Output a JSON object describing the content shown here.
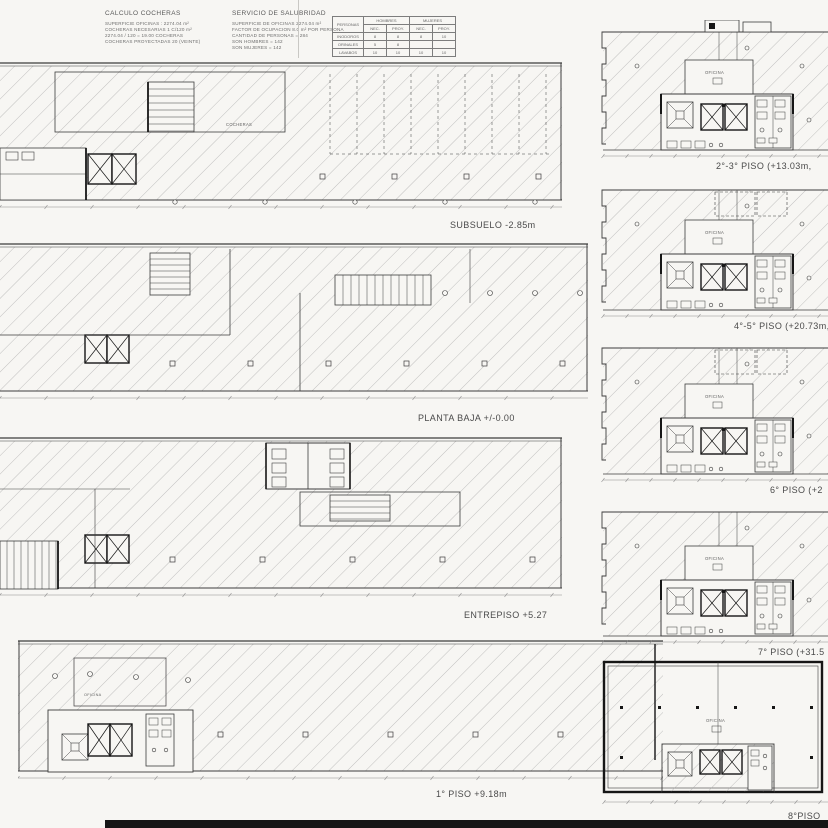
{
  "colors": {
    "paper": "#f7f6f3",
    "ink": "#3c3c3c",
    "heavy": "#161616",
    "hatch": "#a9a9a9",
    "dim": "#8a8a8a",
    "label": "#4a4a4a"
  },
  "header": {
    "calculo": {
      "title": "CALCULO COCHERAS",
      "lines": [
        "SUPERFICIE OFICINAS : 2274.04 m²",
        "COCHERAS NECESARIAS 1 C/120 m²",
        "2274.04 / 120 = 19.00 COCHERAS",
        "COCHERAS PROYECTADAS 20 (VEINTE)"
      ]
    },
    "servicio": {
      "title": "SERVICIO DE SALUBRIDAD",
      "lines": [
        "SUPERFICIE DE OFICINAS 2274.04 m²",
        "FACTOR DE OCUPACION 8.0 m² POR PERSONA",
        "CANTIDAD DE PERSONAS = 284",
        "SON HOMBRES = 142",
        "SON MUJERES = 142"
      ]
    },
    "table": {
      "corner": "PERSONAS",
      "col_groups": [
        "HOMBRES",
        "MUJERES"
      ],
      "sub_cols": [
        "NEC.",
        "PROY.",
        "NEC.",
        "PROY."
      ],
      "rows": [
        {
          "label": "INODOROS",
          "values": [
            "8",
            "8",
            "8",
            "10"
          ]
        },
        {
          "label": "ORINALES",
          "values": [
            "5",
            "8",
            "",
            ""
          ]
        },
        {
          "label": "LAVABOS",
          "values": [
            "10",
            "10",
            "10",
            "10"
          ]
        }
      ]
    }
  },
  "plans_left": [
    {
      "label": "SUBSUELO  -2.85m"
    },
    {
      "label": "PLANTA BAJA  +/-0.00"
    },
    {
      "label": "ENTREPISO  +5.27"
    },
    {
      "label": "1° PISO  +9.18m"
    }
  ],
  "plans_right": [
    {
      "label": "2°-3° PISO  (+13.03m,"
    },
    {
      "label": "4°-5° PISO (+20.73m,+"
    },
    {
      "label": "6° PISO  (+2"
    },
    {
      "label": "7° PISO  (+31.5"
    },
    {
      "label": "8°PISO"
    }
  ],
  "annotations": {
    "oficina": "OFICINA",
    "cocheras": "COCHERAS"
  }
}
